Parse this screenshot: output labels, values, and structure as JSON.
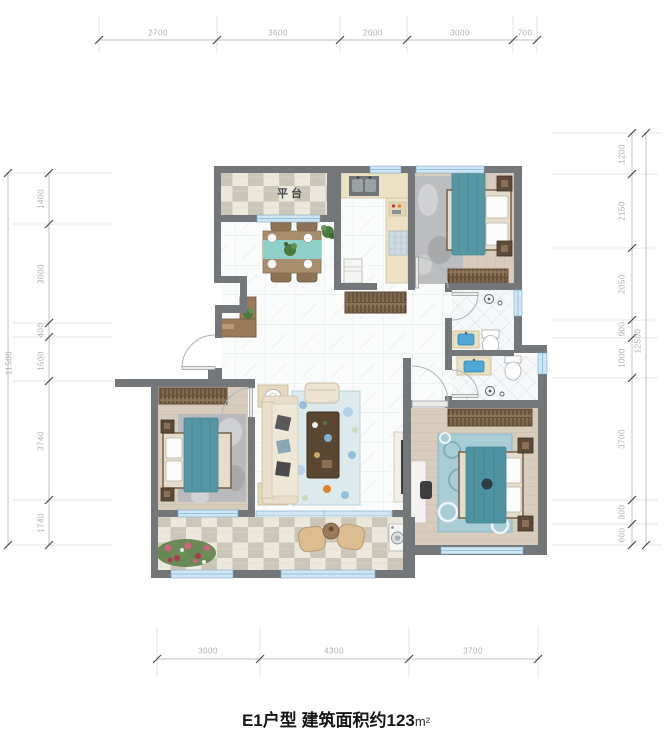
{
  "plan": {
    "balcony_label": "平台"
  },
  "title": {
    "main": "E1户型 建筑面积约123",
    "unit": "m²"
  },
  "dimensions": {
    "top": {
      "segments": [
        "2700",
        "3600",
        "2000",
        "3000",
        "700"
      ]
    },
    "bottom": {
      "segments": [
        "3000",
        "4300",
        "3700"
      ]
    },
    "left": {
      "segments": [
        "1400",
        "3000",
        "400",
        "1500",
        "3740",
        "1740"
      ],
      "total": "11580"
    },
    "right": {
      "segments": [
        "1200",
        "2150",
        "2050",
        "900",
        "1000",
        "3700",
        "900",
        "600"
      ],
      "total": "12500"
    }
  },
  "colors": {
    "wall": "#73777a",
    "window": "#cfe7f5",
    "accent_teal": "#5796a3",
    "floor_wood": "#d8cdbc",
    "dim_text": "#b0b0b0",
    "title_text": "#161616"
  }
}
